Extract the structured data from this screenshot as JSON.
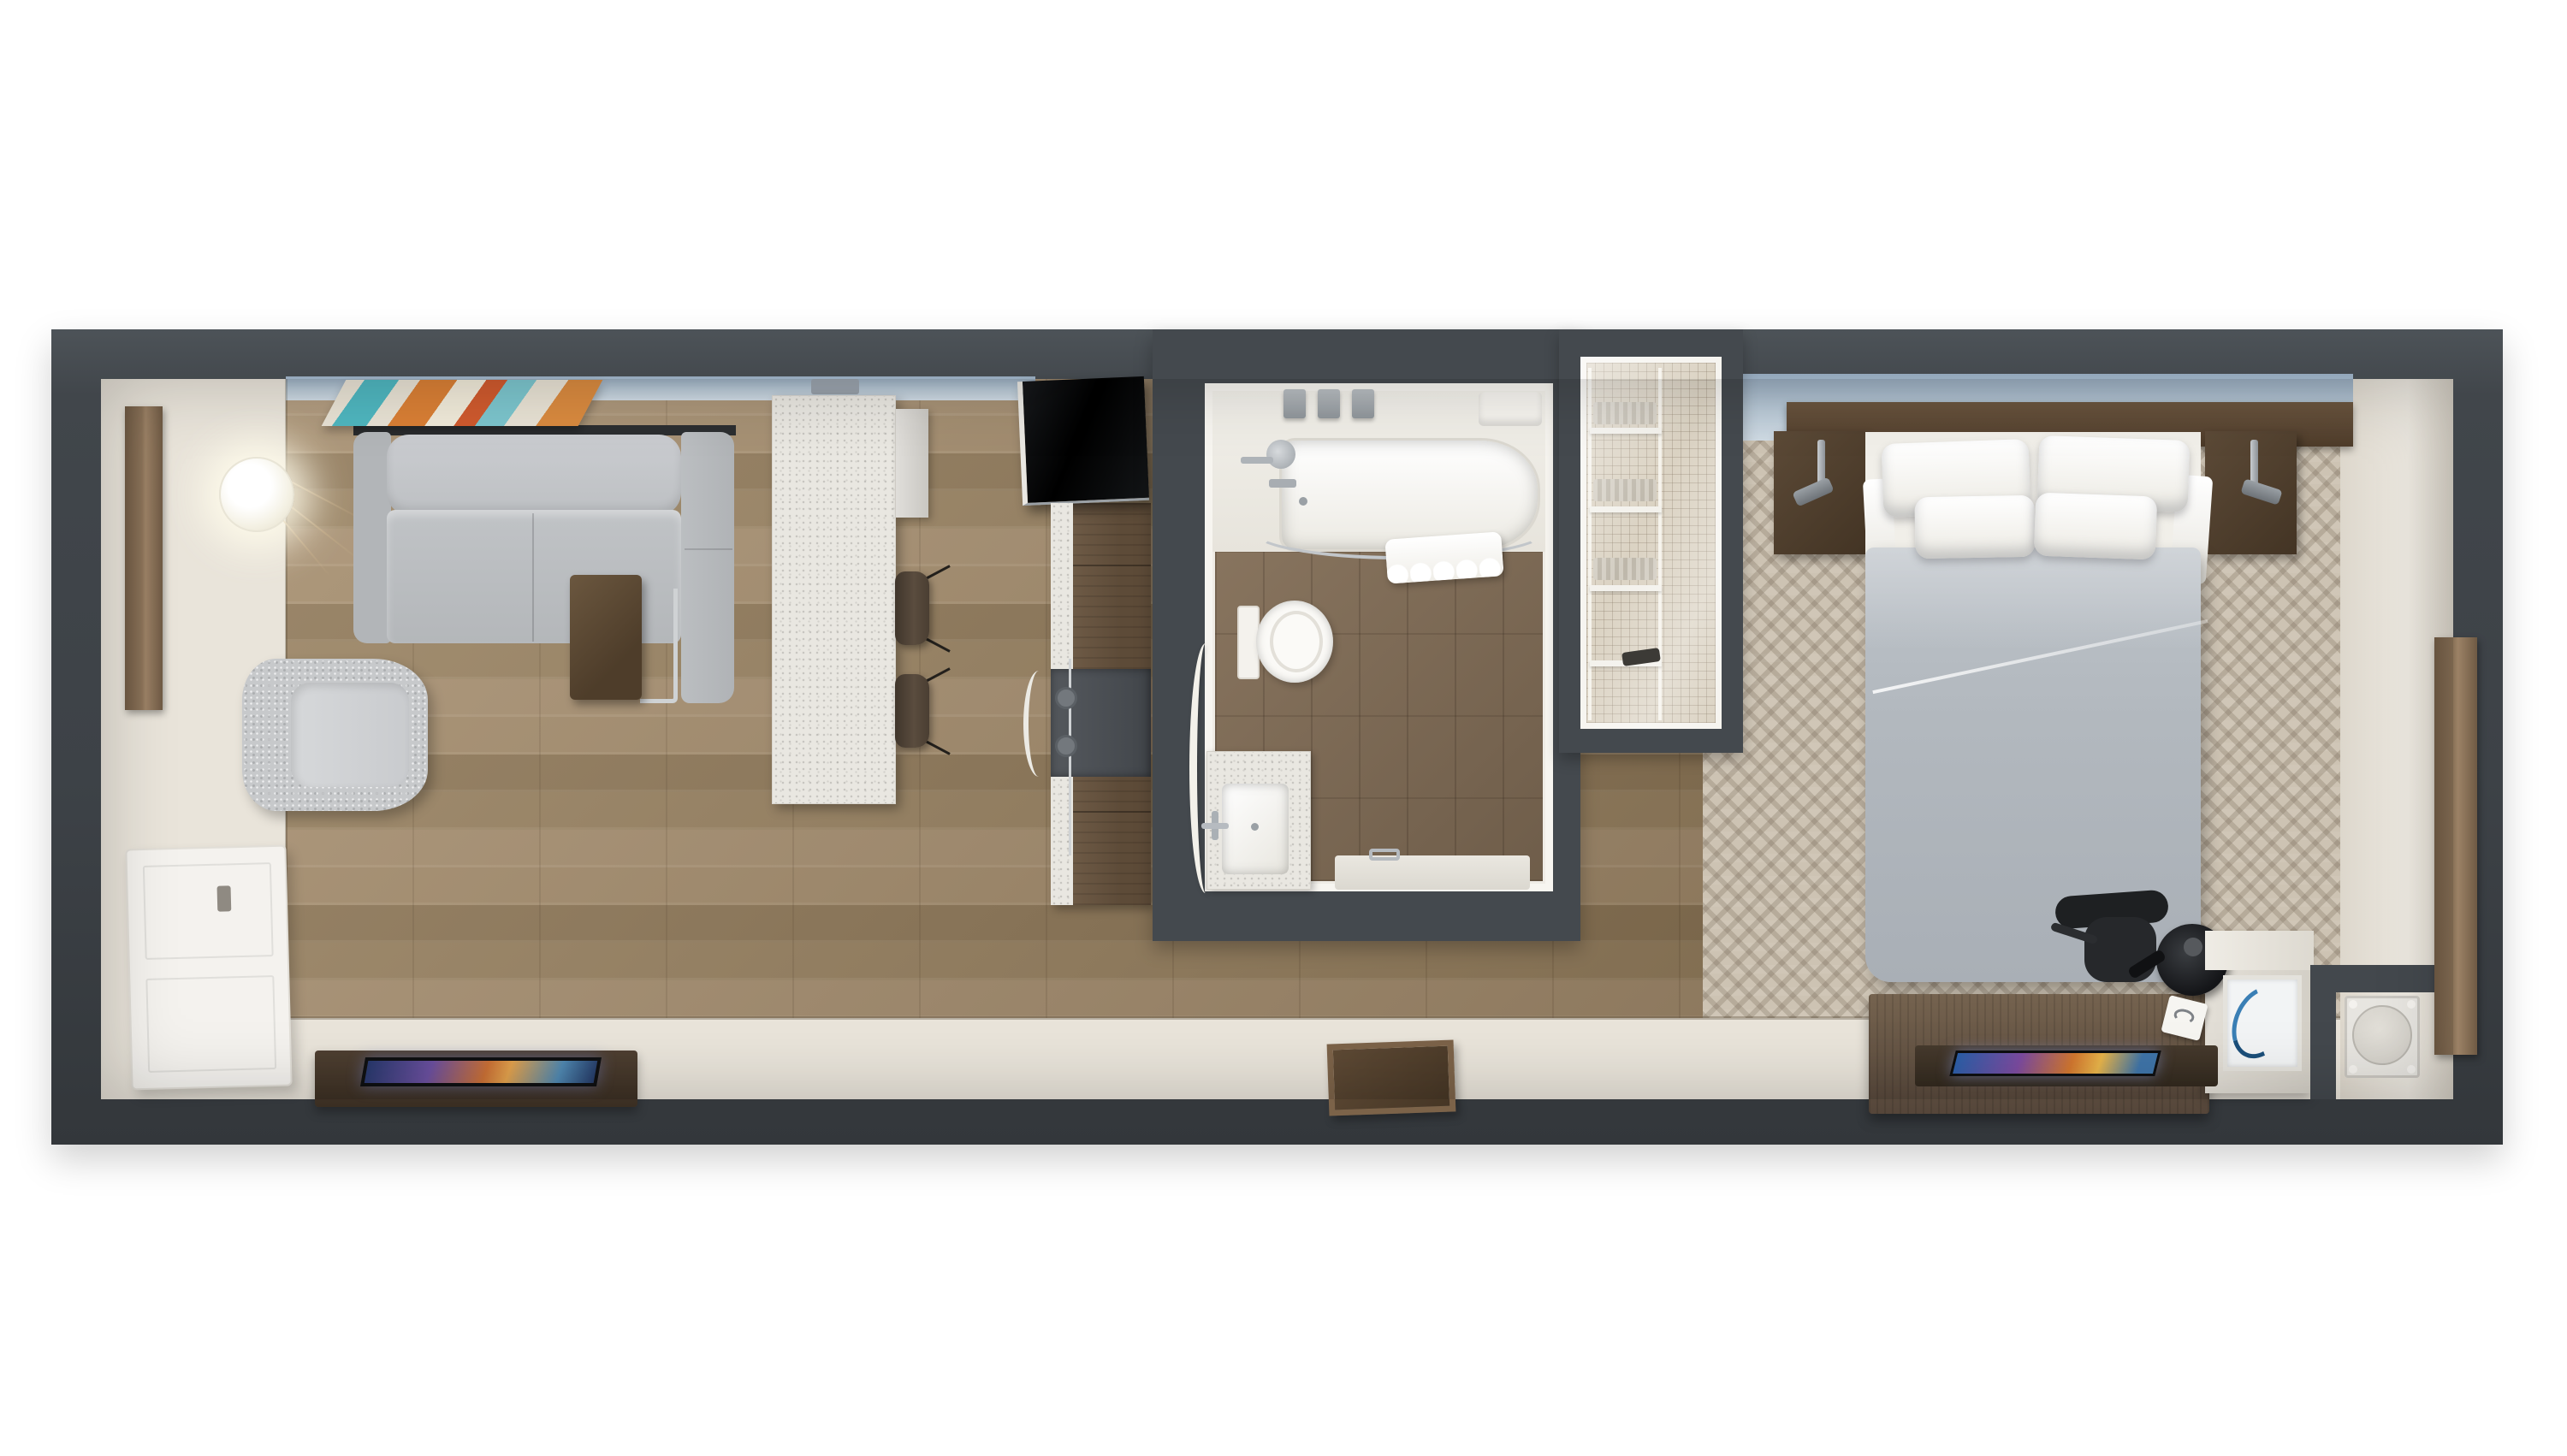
{
  "scene": {
    "kind": "3d-floor-plan-top-view",
    "setting": "hotel suite with living room, kitchenette, bathroom, shower closet and bedroom",
    "visible_text": "none"
  },
  "palette": {
    "page_background": "#ffffff",
    "outer_wall": "#3e4347",
    "inner_wall_trim": "#f7f5f0",
    "wood_floor": "#9c8567",
    "bathroom_floor": "#7e6a54",
    "carpet": "#cdc3b3",
    "cream_floor": "#e9e4da",
    "window_strip": "#b9c9d6",
    "sofa_gray": "#bcbfc2",
    "duvet_gray": "#b2b8be",
    "dark_wood": "#5c4a37",
    "accent_screen": [
      "#2b5fa8",
      "#7c4ba0",
      "#d2772f",
      "#e8b44a"
    ],
    "art_colors": [
      "#4fb6bf",
      "#d97f35",
      "#cf5a2e",
      "#7cc5cd",
      "#e8e2d4"
    ]
  },
  "rooms": [
    {
      "label": "entry",
      "items": [
        "wall mirror plank",
        "pendant globe lamp",
        "entry door",
        "cream floor"
      ]
    },
    {
      "label": "living room",
      "items": [
        "wall art",
        "sectional sofa with chaise",
        "c-shaped side table",
        "swivel armchair",
        "tv console",
        "flat tv"
      ]
    },
    {
      "label": "kitchenette",
      "items": [
        "terrazzo island",
        "island side cabinet",
        "bar stool",
        "bar stool",
        "black appliance unit",
        "counter run with sink strip",
        "under-counter appliance"
      ]
    },
    {
      "label": "bathroom",
      "items": [
        "bathtub",
        "amenity bottles",
        "soap shelf",
        "tub faucet",
        "shower curtain rod",
        "shower curtain",
        "toilet",
        "vanity with sink",
        "open door leaf",
        "bath mat"
      ]
    },
    {
      "label": "shower closet",
      "items": [
        "towel shelving",
        "glass front",
        "mosaic tile floor",
        "shower fixture"
      ]
    },
    {
      "label": "hallway",
      "items": [
        "luggage tray"
      ]
    },
    {
      "label": "bedroom",
      "items": [
        "headboard panel",
        "nightstand with sconce",
        "nightstand with sconce",
        "queen bed with pillows and duvet",
        "work desk",
        "desk chair",
        "coffee maker",
        "note card",
        "tablet tray",
        "dresser with artwork",
        "utility unit nook",
        "wall mirror plank",
        "patterned carpet"
      ]
    }
  ],
  "counts": {
    "pillows": 4,
    "bar_stools": 2,
    "nightstands": 2,
    "amenity_bottles": 3
  }
}
